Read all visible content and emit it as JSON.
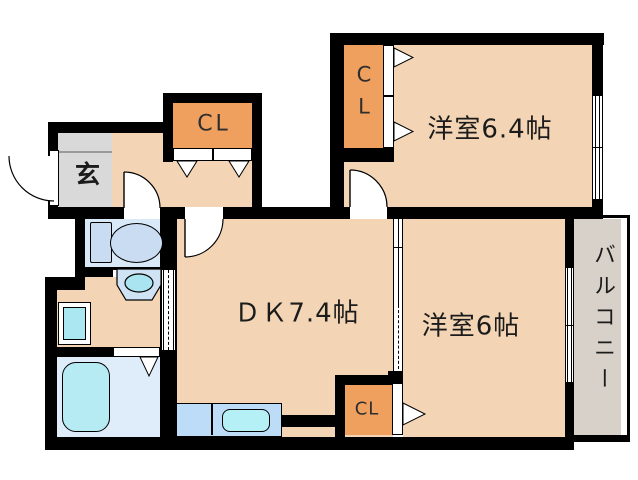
{
  "plan": {
    "rooms": {
      "bedroom1": {
        "label": "洋室6.4帖"
      },
      "bedroom2": {
        "label": "洋室6帖"
      },
      "dining_kitchen": {
        "label": "ＤＫ7.4帖"
      },
      "genkan": {
        "label": "玄"
      },
      "balcony": {
        "label": "バルコニー"
      },
      "closet_hall": {
        "label": "CL"
      },
      "closet_bedroom1": {
        "line1": "C",
        "line2": "L"
      },
      "closet_bedroom2": {
        "label": "CL"
      }
    },
    "colors": {
      "wall": "#000000",
      "floor": "#f3d5b5",
      "closet": "#efa05e",
      "genkan_floor": "#d9d9d9",
      "wet_area": "#d9e9f8",
      "fixture_blue": "#c9dcf2",
      "bath_floor": "#deedf9",
      "tub": "#b6ebf4",
      "pan_inner": "#abe7f1",
      "vanity": "#cfe3f5",
      "vanity_sink": "#a9e4f0",
      "counter": "#bcdcf7",
      "counter_sink": "#b4f0f6",
      "balcony_floor": "#d8d1ca"
    }
  }
}
